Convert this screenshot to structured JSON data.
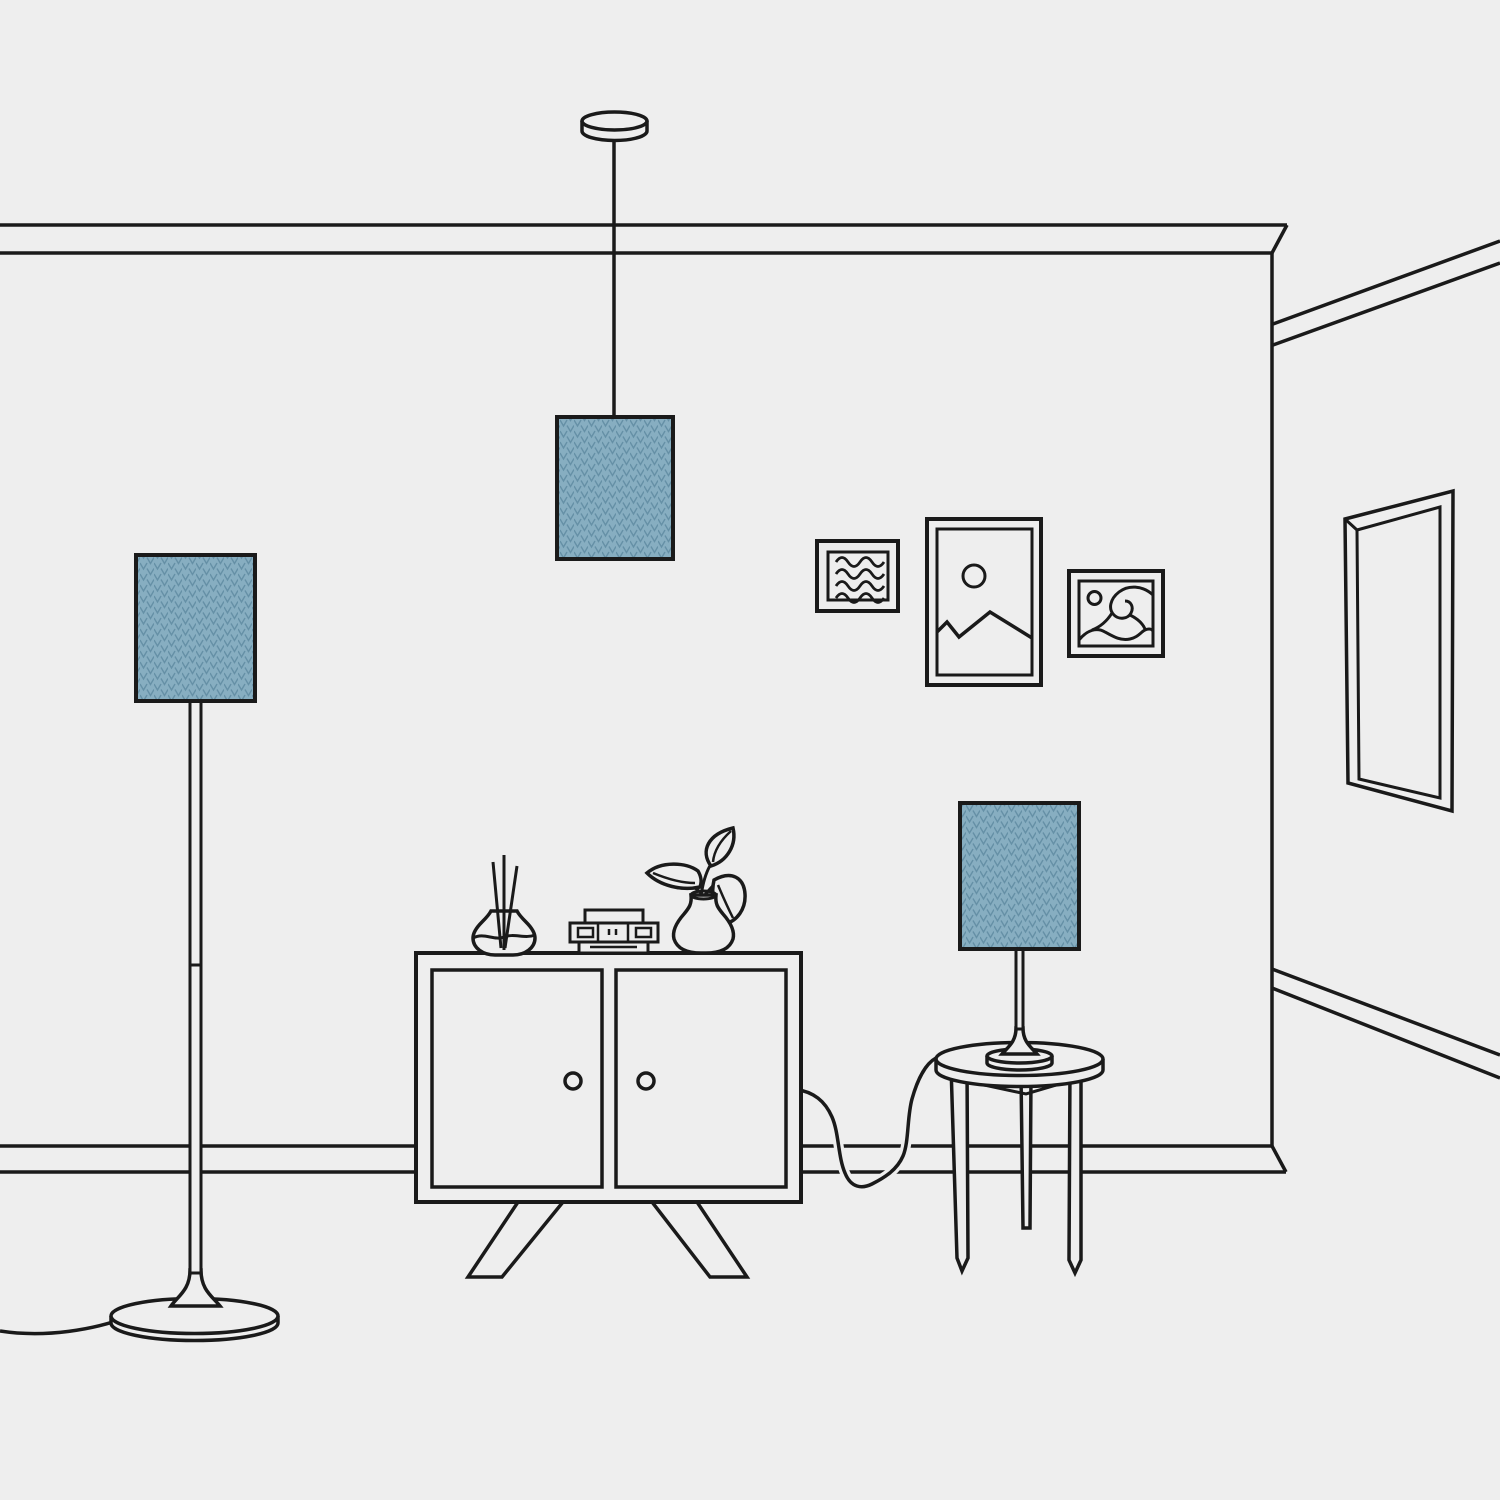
{
  "scene": {
    "description": "Minimal line-art illustration of a living room: a pendant lamp, a floor lamp and a table lamp with matching blue chevron-patterned shades, a two-door cabinet topped with a reed diffuser, a small stack of books and a vase with a leafy plant, a round three-legged side table, three framed pictures on the wall and a tall mirror on the side wall.",
    "objects": [
      "pendant lamp",
      "floor lamp",
      "table lamp",
      "two-door cabinet",
      "reed diffuser",
      "book stack",
      "plant vase",
      "round side table",
      "wavy-lines picture frame",
      "mountain picture frame",
      "wave picture frame",
      "wall mirror"
    ]
  },
  "colors": {
    "background": "#eeeeee",
    "line": "#1a1a1a",
    "lampshade_base": "#87aec1",
    "lampshade_pattern": "#6590a6"
  }
}
